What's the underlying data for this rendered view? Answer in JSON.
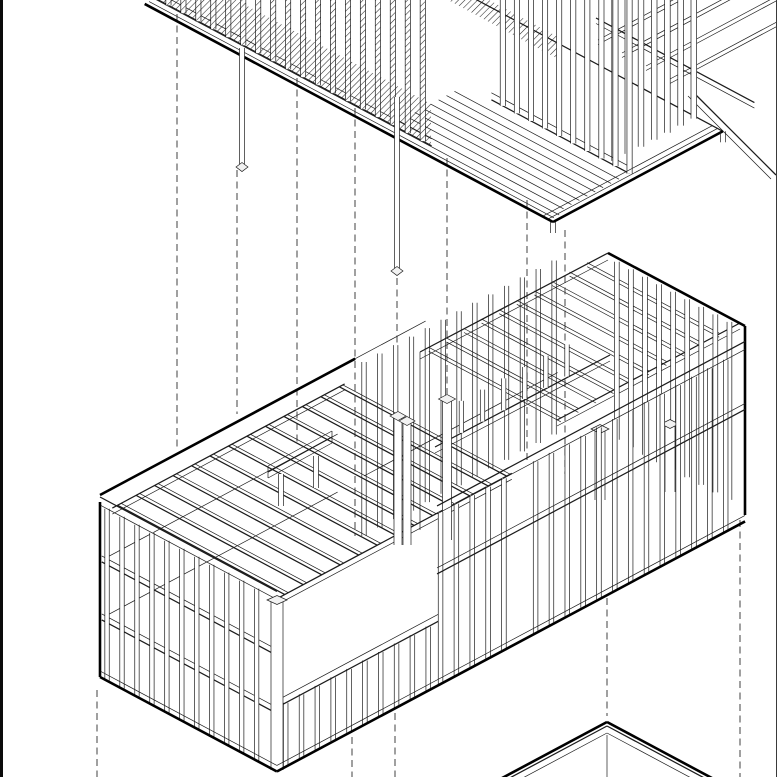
{
  "canvas": {
    "width": 777,
    "height": 777,
    "background": "#ffffff"
  },
  "frame": {
    "left_border_color": "#0a0a0a",
    "right_border_color": "#3a3a3a"
  },
  "style": {
    "line_color": "#1c1c1c",
    "thick_color": "#000000",
    "thin": 0.7,
    "mid": 1.25,
    "thick": 2.6,
    "stud_fill": "#ffffff",
    "cap_fill": "#f2f2f2",
    "hatch_color": "#2a2a2a",
    "hatch_spacing": 4.5,
    "dash_color": "#4a4a4a",
    "dash_width": 1.05,
    "dash_pattern": "7 4.5"
  },
  "projection": {
    "u": [
      0.88,
      0.47
    ],
    "v": [
      0.88,
      -0.47
    ]
  },
  "upper_module": {
    "deck_front_corner": [
      553,
      222
    ],
    "deck_length": 464,
    "deck_width": 193,
    "rim_offsets_v": [
      5,
      11
    ],
    "rim_offsets_u": [
      6,
      12
    ],
    "board_offsets": [
      20,
      29,
      38,
      47,
      56,
      65,
      74,
      83
    ],
    "board_u0": 8,
    "board_u1": 195,
    "back_deck_edge_len": 300,
    "wall1": {
      "inset_v": 12,
      "u0": 160,
      "u1": 465,
      "step": 17,
      "halfw": 2.6
    },
    "wall2": {
      "inset_v": 95,
      "u0": 8,
      "u1": 165,
      "step": 16,
      "halfw": 2.6
    },
    "end_wall": {
      "inset_u": 30,
      "v0": 100,
      "v1": 190,
      "step": 15,
      "halfw": 2.8
    },
    "joist_starts": [
      [
        598,
        40
      ],
      [
        622,
        53
      ],
      [
        646,
        66
      ],
      [
        670,
        79
      ]
    ],
    "joist_len": 260,
    "top_beam": {
      "from": [
        596,
        18
      ],
      "len": 180
    },
    "brace": {
      "from": [
        693,
        92
      ],
      "to": [
        776,
        175
      ]
    },
    "hatch_polys": [
      [
        [
          158,
          0
        ],
        [
          431,
          146
        ],
        [
          431,
          104
        ],
        [
          236,
          0
        ]
      ],
      [
        [
          448,
          0
        ],
        [
          560,
          60
        ],
        [
          560,
          38
        ],
        [
          489,
          0
        ]
      ]
    ]
  },
  "middle_module": {
    "origin": [
      100,
      677
    ],
    "width": 201,
    "length": 532,
    "height": 182,
    "left_wall": {
      "u0": 8,
      "u1": 190,
      "step": 17,
      "halfw": 2.2,
      "stud_top": 172,
      "rail_heights": [
        58,
        116
      ],
      "plate_heights": [
        172,
        180
      ]
    },
    "front_wall": {
      "low": {
        "v0": 10,
        "v1": 180,
        "step": 18,
        "top": 64,
        "rail_heights": [
          64,
          71
        ]
      },
      "high": {
        "v0": 186,
        "v1": 526,
        "step": 18,
        "top": 172,
        "gap_v0": 268,
        "gap_v1": 292,
        "rail_heights": [
          112,
          118
        ],
        "band_heights": [
          172,
          180
        ]
      },
      "halfw": 2.3
    },
    "back_rails": {
      "heights": [
        58,
        116
      ],
      "v0": 6,
      "v1": 270
    },
    "back_studs": {
      "v0": 300,
      "v1": 520,
      "step": 18,
      "top": 174,
      "halfw": 2.2
    },
    "left_joists": {
      "v0": 14,
      "v1": 266,
      "step": 21,
      "z": 168,
      "u0": 6,
      "u1": 196
    },
    "right_room": {
      "back_top_corner": [
        608,
        253
      ],
      "back_plate_start": [
        420,
        352
      ],
      "u_edge_end": [
        745,
        326
      ],
      "right_corner_bottom": [
        745,
        515
      ],
      "joist_s0": 10,
      "joist_s1": 190,
      "joist_step": 20,
      "joist_run": 150,
      "front_beam": [
        [
          557,
          420
        ],
        [
          740,
          323
        ]
      ],
      "clerestory_beam": [
        [
          435,
          447
        ],
        [
          610,
          355
        ]
      ],
      "clerestory_studs": {
        "s0": 30,
        "s1": 150,
        "step": 24,
        "h": 32
      },
      "end_wall": {
        "base_from": [
          608,
          435
        ],
        "u0": 10,
        "u1": 150,
        "step": 16,
        "top": 178,
        "halfw": 2.4
      }
    },
    "corner_post": {
      "x": 277,
      "halfw": 6,
      "y_top": 599,
      "y_bot": 770
    },
    "posts": [
      {
        "x": 398,
        "halfw": 4,
        "pair_dx": 9,
        "y_top": 415,
        "y_bot": 545
      },
      {
        "x": 447,
        "halfw": 4.5,
        "pair_dx": 0,
        "y_top": 398,
        "y_bot": 540
      },
      {
        "x": 600,
        "halfw": 5,
        "pair_dx": 0,
        "y_top": 428,
        "y_bot": 500
      },
      {
        "x": 670,
        "halfw": 5,
        "pair_dx": 0,
        "y_top": 423,
        "y_bot": 492
      }
    ],
    "header": {
      "p1": [
        268,
        472
      ],
      "p2": [
        332,
        437
      ],
      "posts": [
        {
          "x": 281,
          "y1": 474,
          "y2": 506
        },
        {
          "x": 316,
          "y1": 456,
          "y2": 488
        }
      ]
    }
  },
  "lower_module": {
    "apex": [
      607,
      722
    ],
    "inner_drop": 11,
    "outer_len": 140,
    "inner_len": 122,
    "double_offset": 4
  },
  "pins": [
    {
      "x": 242,
      "y1": 48,
      "y2": 164,
      "halfw": 2.5
    },
    {
      "x": 397,
      "y1": 97,
      "y2": 268,
      "halfw": 2.5
    }
  ],
  "dashed_lines": [
    {
      "x": 177,
      "y1": 14,
      "y2": 450
    },
    {
      "x": 237,
      "y1": 170,
      "y2": 414
    },
    {
      "x": 297,
      "y1": 78,
      "y2": 446
    },
    {
      "x": 355,
      "y1": 108,
      "y2": 536
    },
    {
      "x": 397,
      "y1": 278,
      "y2": 410
    },
    {
      "x": 447,
      "y1": 158,
      "y2": 394
    },
    {
      "x": 527,
      "y1": 200,
      "y2": 462
    },
    {
      "x": 565,
      "y1": 230,
      "y2": 474
    },
    {
      "x": 97,
      "y1": 690,
      "y2": 777
    },
    {
      "x": 352,
      "y1": 737,
      "y2": 777
    },
    {
      "x": 395,
      "y1": 713,
      "y2": 777
    },
    {
      "x": 607,
      "y1": 598,
      "y2": 716
    },
    {
      "x": 740,
      "y1": 520,
      "y2": 777
    }
  ]
}
